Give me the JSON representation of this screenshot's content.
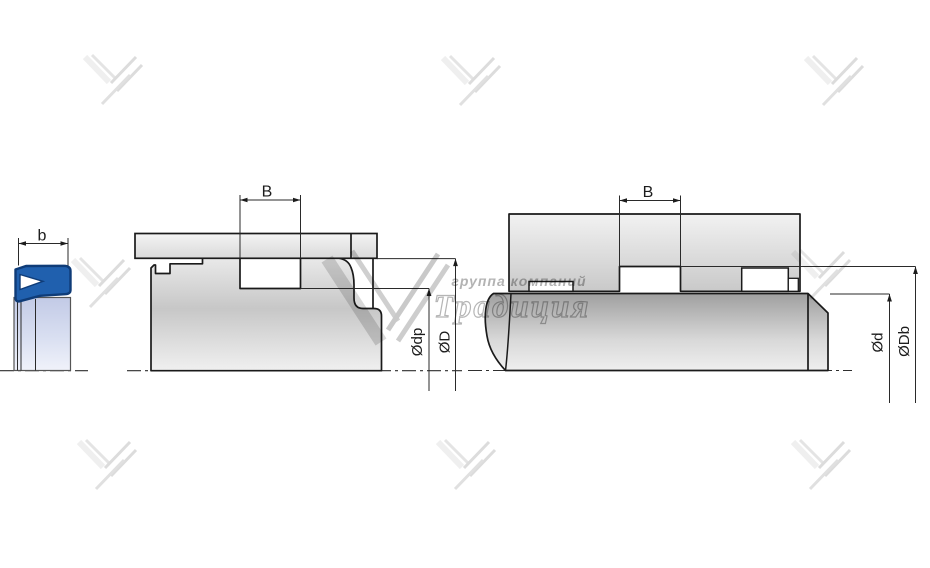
{
  "watermark": {
    "small_text": "группа компаний",
    "large_text": "Традиция"
  },
  "left_figure": {
    "width_label": "b"
  },
  "middle_figure": {
    "groove_width_label": "B",
    "groove_diameter_label": "Ødp",
    "bore_diameter_label": "ØD"
  },
  "right_figure": {
    "groove_width_label": "B",
    "rod_diameter_label": "Ød",
    "groove_diameter_label": "ØDb"
  },
  "colors": {
    "seal_blue": "#2060ae",
    "seal_outline": "#0f3c78",
    "drawing_line": "#1a1a1a",
    "watermark_gray": "#c9c9c9",
    "rod_column_blue": "#c6cde9"
  }
}
